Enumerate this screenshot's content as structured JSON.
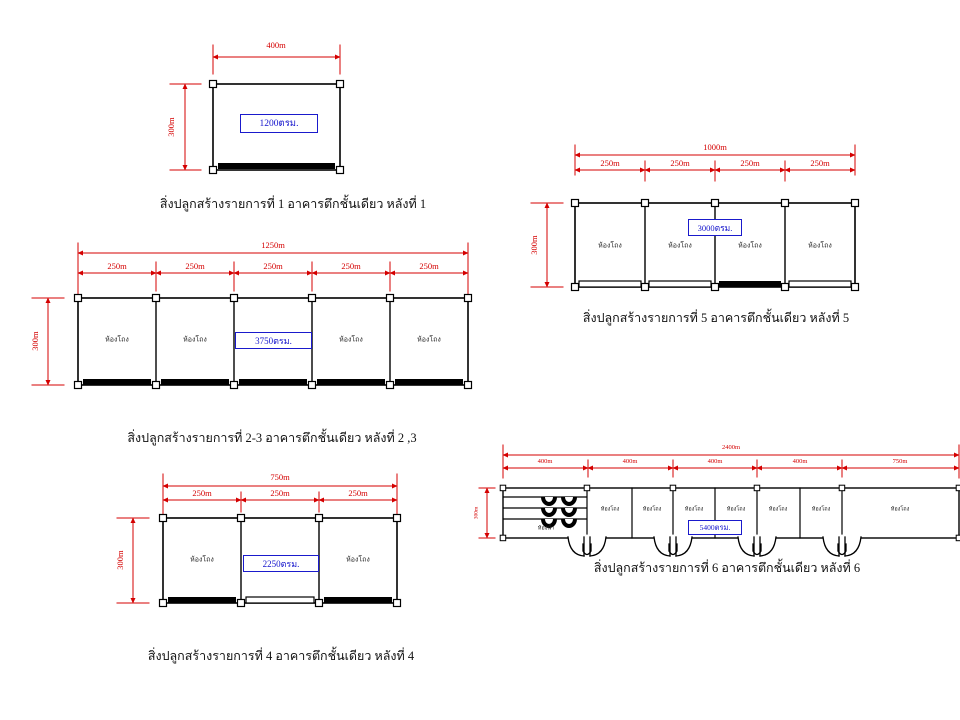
{
  "drawing": {
    "colors": {
      "dimension": "#d40000",
      "wall": "#000000",
      "area_box": "#1a1acc"
    },
    "buildings": {
      "b1": {
        "caption": "สิ่งปลูกสร้างรายการที่ 1 อาคารตึกชั้นเดียว หลังที่ 1",
        "width_label": "400m",
        "height_label": "300m",
        "area_label": "1200ตรม."
      },
      "b23": {
        "caption": "สิ่งปลูกสร้างรายการที่ 2-3 อาคารตึกชั้นเดียว หลังที่ 2 ,3",
        "total_label": "1250m",
        "height_label": "300m",
        "area_label": "3750ตรม.",
        "segment_labels": [
          "250m",
          "250m",
          "250m",
          "250m",
          "250m"
        ],
        "room_labels": [
          "ห้องโถง",
          "ห้องโถง",
          "ห้องโถง",
          "ห้องโถง"
        ]
      },
      "b4": {
        "caption": "สิ่งปลูกสร้างรายการที่ 4 อาคารตึกชั้นเดียว หลังที่ 4",
        "total_label": "750m",
        "height_label": "300m",
        "area_label": "2250ตรม.",
        "segment_labels": [
          "250m",
          "250m",
          "250m"
        ],
        "room_labels": [
          "ห้องโถง",
          "ห้องโถง"
        ]
      },
      "b5": {
        "caption": "สิ่งปลูกสร้างรายการที่ 5 อาคารตึกชั้นเดียว หลังที่ 5",
        "total_label": "1000m",
        "height_label": "300m",
        "area_label": "3000ตรม.",
        "segment_labels": [
          "250m",
          "250m",
          "250m",
          "250m"
        ],
        "room_labels": [
          "ห้องโถง",
          "ห้องโถง",
          "ห้องโถง",
          "ห้องโถง"
        ]
      },
      "b6": {
        "caption": "สิ่งปลูกสร้างรายการที่ 6 อาคารตึกชั้นเดียว หลังที่ 6",
        "total_label": "2400m",
        "height_label": "300m",
        "area_label": "5400ตรม.",
        "segment_labels": [
          "400m",
          "400m",
          "400m",
          "400m",
          "750m"
        ],
        "room_labels": [
          "ห้องโถง",
          "ห้องโถง",
          "ห้องโถง",
          "ห้องโถง",
          "ห้องโถง",
          "ห้องโถง",
          "ห้องโถง"
        ],
        "bathroom_label": "ห้องน้ำ"
      }
    }
  }
}
